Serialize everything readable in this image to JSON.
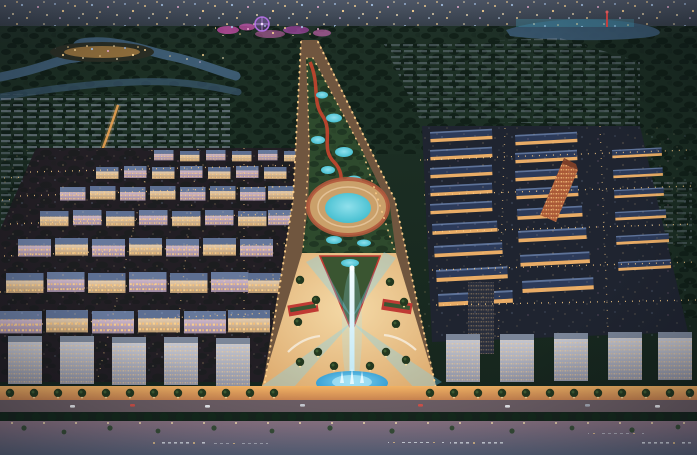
{
  "scene": {
    "title": "Aerial dusk rendering of a coastal master-planned city with a central boulevard, light tower fountain plaza, and beachfront promenade",
    "landmarks": {
      "ferris_wheel": "amusement park ferris wheel",
      "amusement_park": "pink-lit amusement park",
      "river_island": "golden-lit island in winding river",
      "lakeside_complex": "cyan-lit lakeside complex with red tower",
      "boulevard": "central landscaped boulevard",
      "ring_plaza": "circular ring plaza with teal lagoon",
      "light_tower": "white light tower with radiating beams",
      "fountain": "blue fountain pool",
      "beach": "dusk beach with lounger rows",
      "promenade": "palm-lined beachfront promenade"
    },
    "palette": {
      "sky_top": "#515a6a",
      "distant_band": "#39424e",
      "field_dark": "#15241c",
      "field_mid": "#1d3025",
      "tree_dark": "#0e1c15",
      "river": "#41607b",
      "lake": "#3a5871",
      "island_glow": "#e8a852",
      "ferris_wheel": "#b06ee0",
      "park_pink": "#d254b4",
      "red_tower": "#e04848",
      "cyan_lights": "#49c4dc",
      "road_asphalt": "#70563f",
      "streetlight": "#ffd089",
      "median_green": "#2e4a2d",
      "pond_teal": "#3fbcce",
      "pond_light": "#8fe0ec",
      "ring_ground": "#caa06a",
      "path_red": "#c6452f",
      "plaza_bright": "#f4d9a6",
      "plaza_sand": "#dca86b",
      "park_triangle": "#3a5531",
      "flower_red": "#c03a34",
      "tower_white": "#f4fcff",
      "tower_base": "#bfe8f5",
      "beam_cyan": "rgba(110,215,255,0.32)",
      "fountain_blue": "#2591cc",
      "fountain_light": "#83d7f2",
      "facade_lavender_hi": "#cbb6ca",
      "facade_lavender_lo": "#9b87a0",
      "facade_cream_hi": "#e3cdb2",
      "facade_cream_lo": "#b9986f",
      "window_warm": "#ffd28a",
      "roof_slate": "#66789b",
      "roof_navy": "#2c3a59",
      "shophouse_eave": "#f4b469",
      "orange_building": "#aa5a38",
      "slab_hi": "#c3c5cf",
      "slab_lo": "#8f93a5",
      "suburb_gray": "#8e9aab",
      "promenade_hi": "#f0b264",
      "promenade_lo": "#c77f4e",
      "coastal_road": "#6d5f66",
      "palm_green": "#23381f",
      "beach_warm": "#8d7585",
      "beach_cool": "#5d6880",
      "chair_light": "#d9dee8",
      "car_red": "#d2524a",
      "car_white": "#eceef2",
      "dot_warm": "#ffd794",
      "dot_cool": "#a9c6ea"
    }
  }
}
